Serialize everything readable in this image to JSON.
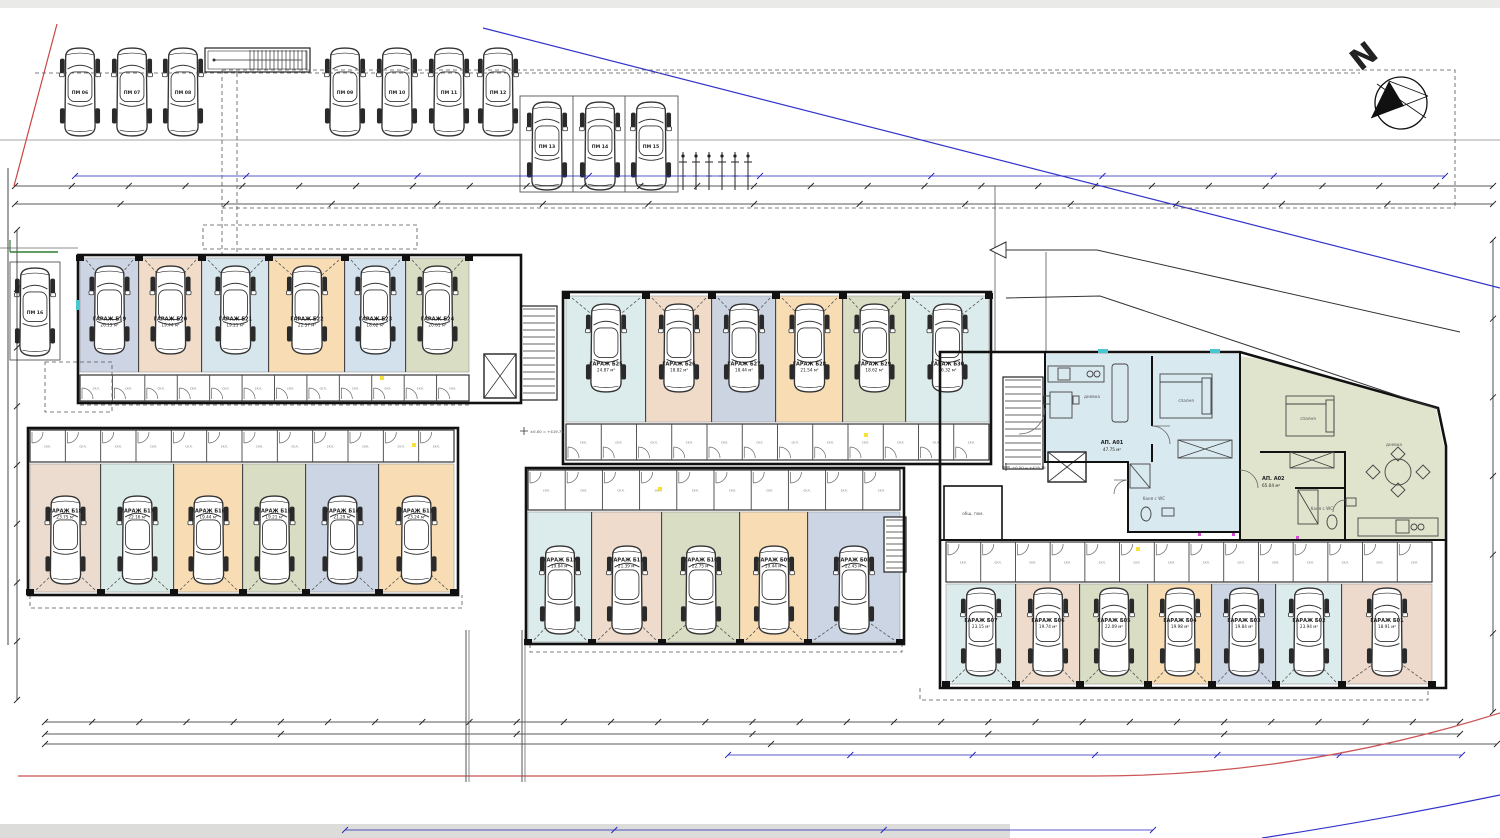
{
  "north": {
    "label": "N"
  },
  "level_mark": "±0.00 = +419.75",
  "storage_room_label": "скл.",
  "common_room": {
    "label": "общ. пом."
  },
  "parking": [
    {
      "label": "ПМ 06"
    },
    {
      "label": "ПМ 07"
    },
    {
      "label": "ПМ 08"
    },
    {
      "label": "ПМ 09"
    },
    {
      "label": "ПМ 10"
    },
    {
      "label": "ПМ 11"
    },
    {
      "label": "ПМ 12"
    },
    {
      "label": "ПМ 13"
    },
    {
      "label": "ПМ 14"
    },
    {
      "label": "ПМ 15"
    },
    {
      "label": "ПМ 16"
    }
  ],
  "apartments": [
    {
      "name": "АП. А01",
      "area": "47.75 м²",
      "color": "#d9e9f0",
      "rooms": [
        "дневна",
        "спалня",
        "баня с WC"
      ]
    },
    {
      "name": "АП. А02",
      "area": "65.04 м²",
      "color": "#e0e4cd",
      "rooms": [
        "спалня",
        "дневна",
        "баня с WC"
      ]
    }
  ],
  "garages": {
    "top_left": [
      {
        "name": "ГАРАЖ Б19",
        "area": "26.15 м²",
        "color": "#cdd4e3"
      },
      {
        "name": "ГАРАЖ Б20",
        "area": "19.44 м²",
        "color": "#f0dcc9"
      },
      {
        "name": "ГАРАЖ Б21",
        "area": "19.21 м²",
        "color": "#d6e6ec"
      },
      {
        "name": "ГАРАЖ Б22",
        "area": "22.37 м²",
        "color": "#f8ddb4"
      },
      {
        "name": "ГАРАЖ Б23",
        "area": "18.62 м²",
        "color": "#d2e1ec"
      },
      {
        "name": "ГАРАЖ Б24",
        "area": "20.61 м²",
        "color": "#d9ddc4"
      }
    ],
    "top_middle": [
      {
        "name": "ГАРАЖ Б25",
        "area": "24.87 м²",
        "color": "#dcebec"
      },
      {
        "name": "ГАРАЖ Б26",
        "area": "18.82 м²",
        "color": "#f0dbc8"
      },
      {
        "name": "ГАРАЖ Б27",
        "area": "18.44 м²",
        "color": "#ccd4e2"
      },
      {
        "name": "ГАРАЖ Б28",
        "area": "21.54 м²",
        "color": "#f8ddb4"
      },
      {
        "name": "ГАРАЖ Б29",
        "area": "18.62 м²",
        "color": "#d9ddc4"
      },
      {
        "name": "ГАРАЖ Б30",
        "area": "26.32 м²",
        "color": "#dcebec"
      }
    ],
    "left_bottom": [
      {
        "name": "ГАРАЖ Б18",
        "area": "23.75 м²",
        "color": "#ecdccf"
      },
      {
        "name": "ГАРАЖ Б17",
        "area": "22.16 м²",
        "color": "#daeae6"
      },
      {
        "name": "ГАРАЖ Б16",
        "area": "19.44 м²",
        "color": "#f8ddb4"
      },
      {
        "name": "ГАРАЖ Б15",
        "area": "19.21 м²",
        "color": "#d9ddc4"
      },
      {
        "name": "ГАРАЖ Б14",
        "area": "21.29 м²",
        "color": "#ccd5e4"
      },
      {
        "name": "ГАРАЖ Б13",
        "area": "23.24 м²",
        "color": "#f8ddb4"
      }
    ],
    "middle_bottom": [
      {
        "name": "ГАРАЖ Б12",
        "area": "19.84 м²",
        "color": "#dcebec"
      },
      {
        "name": "ГАРАЖ Б11",
        "area": "21.39 м²",
        "color": "#eedbcb"
      },
      {
        "name": "ГАРАЖ Б10",
        "area": "22.75 м²",
        "color": "#d9ddc4"
      },
      {
        "name": "ГАРАЖ Б09",
        "area": "19.44 м²",
        "color": "#f8ddb4"
      },
      {
        "name": "ГАРАЖ Б08",
        "area": "22.45 м²",
        "color": "#ccd5e4"
      }
    ],
    "right_bottom": [
      {
        "name": "ГАРАЖ Б07",
        "area": "23.15 м²",
        "color": "#dcebec"
      },
      {
        "name": "ГАРАЖ Б06",
        "area": "19.74 м²",
        "color": "#eedbcb"
      },
      {
        "name": "ГАРАЖ Б05",
        "area": "22.09 м²",
        "color": "#d9ddc4"
      },
      {
        "name": "ГАРАЖ Б04",
        "area": "19.98 м²",
        "color": "#f8ddb4"
      },
      {
        "name": "ГАРАЖ Б03",
        "area": "19.84 м²",
        "color": "#ccd5e4"
      },
      {
        "name": "ГАРАЖ Б02",
        "area": "23.94 м²",
        "color": "#dcebec"
      },
      {
        "name": "ГАРАЖ Б01",
        "area": "18.91 м²",
        "color": "#eedacd",
        "bold": true
      }
    ]
  }
}
